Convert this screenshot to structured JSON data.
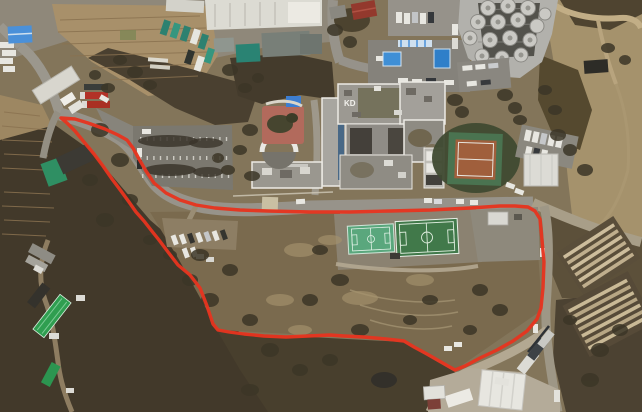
{
  "scene": {
    "type": "satellite-aerial-photograph",
    "description": "Aerial view of a hillside campus: building complex with rooftop lettering, circular tank facility, tennis court, two green sports fields, parking lots, farm buildings, and a red boundary line enclosing a land parcel",
    "roof_lettering": "KD"
  },
  "palette": {
    "boundary_red": "#e6341f",
    "terrain_tan": "#83755a",
    "woodland_dark": "#42392a",
    "road_gray": "#98948a",
    "roof_white": "#efeee9",
    "soccer_green": "#41794a",
    "futsal_green": "#5aa77d",
    "tennis_clay": "#a05f3c",
    "farm_roof_green": "#2f9e50",
    "tank_gray": "#cac9c4",
    "canopy_blue": "#3f8fd6"
  },
  "boundary": {
    "label": "site-boundary",
    "color": "#e6341f",
    "stroke_width": "3.4",
    "points": "61,118 75,119 88,123 105,129 118,135 127,140 133,148 139,159 146,171 154,183 166,193 180,200 196,205 215,208 240,210 268,211 310,212 350,212 390,211 430,210 470,208 500,206 515,206 528,207 535,211 540,219 542,240 544,262 543,288 541,308 537,319 527,331 513,341 497,350 480,358 465,366 455,370 441,362 427,354 414,347 404,341 386,339 364,337 344,336 330,335 308,336 286,337 264,336 244,334 229,332 218,330 213,324 207,306 200,288 190,275 178,265 168,252 159,240 151,230 144,221 136,212 129,202 121,191 112,179 103,166 94,154 84,142 75,131 67,123 61,118"
  },
  "features": [
    {
      "id": "industrial-yard",
      "label": "industrial yard with trucks and warehouses"
    },
    {
      "id": "terraced-fields",
      "label": "terraced farm plots"
    },
    {
      "id": "main-building-complex",
      "label": "large multi-wing building"
    },
    {
      "id": "tank-facility",
      "label": "cluster of circular tanks"
    },
    {
      "id": "tennis-court",
      "label": "clay tennis court"
    },
    {
      "id": "soccer-field",
      "label": "soccer field with white markings"
    },
    {
      "id": "futsal-court",
      "label": "small green court"
    },
    {
      "id": "site-boundary",
      "label": "red parcel boundary overlay"
    }
  ]
}
